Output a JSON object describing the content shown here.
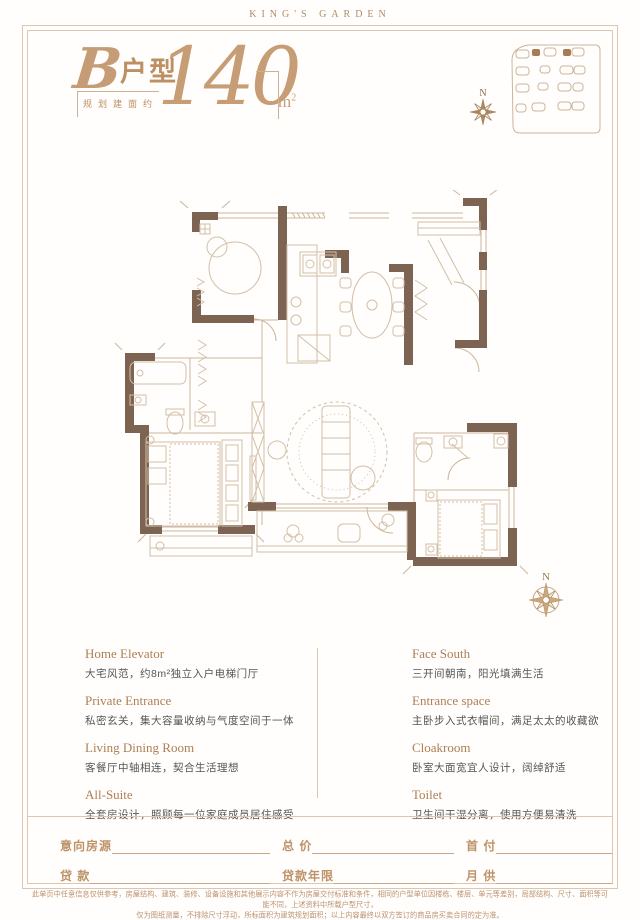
{
  "brand": "KING'S GARDEN",
  "title": {
    "unit_letter": "B",
    "unit_type": "户型",
    "plan_label": "规划建面约",
    "area_number": "140",
    "area_unit_m": "m",
    "area_unit_sup": "2"
  },
  "compass": {
    "north": "N"
  },
  "features": {
    "left": [
      {
        "title": "Home Elevator",
        "desc": "大宅风范，约8m²独立入户电梯门厅"
      },
      {
        "title": "Private Entrance",
        "desc": "私密玄关，集大容量收纳与气度空间于一体"
      },
      {
        "title": "Living Dining Room",
        "desc": "客餐厅中轴相连，契合生活理想"
      },
      {
        "title": "All-Suite",
        "desc": "全套房设计，照顾每一位家庭成员居住感受"
      }
    ],
    "right": [
      {
        "title": "Face South",
        "desc": "三开间朝南，阳光填满生活"
      },
      {
        "title": "Entrance space",
        "desc": "主卧步入式衣帽间，满足太太的收藏欲"
      },
      {
        "title": "Cloakroom",
        "desc": "卧室大面宽宜人设计，阔绰舒适"
      },
      {
        "title": "Toilet",
        "desc": "卫生间干湿分离，使用方便易清洗"
      }
    ]
  },
  "form": {
    "fields": [
      {
        "label": "意向房源"
      },
      {
        "label": "总 价"
      },
      {
        "label": "首 付"
      },
      {
        "label": "贷 款"
      },
      {
        "label": "贷款年限"
      },
      {
        "label": "月 供"
      }
    ]
  },
  "footer": {
    "line1": "此单页中任意信息仅供参考，房屋结构、建筑、装修、设备设施和其他展示内容不作为房屋交付标准和条件，相同的户型单位因楼栋、楼层、单元等差别，局部结构、尺寸、面积等可能不同，上述资料中所载户型尺寸，",
    "line2": "仅为图纸测量，不排除尺寸浮动，所标面积为建筑规划面积；以上内容最终以双方签订的商品房买卖合同的定为准。"
  },
  "colors": {
    "accent": "#b9906a",
    "wall": "#7d6452",
    "line": "#d9c3ac",
    "body_text": "#555555"
  }
}
